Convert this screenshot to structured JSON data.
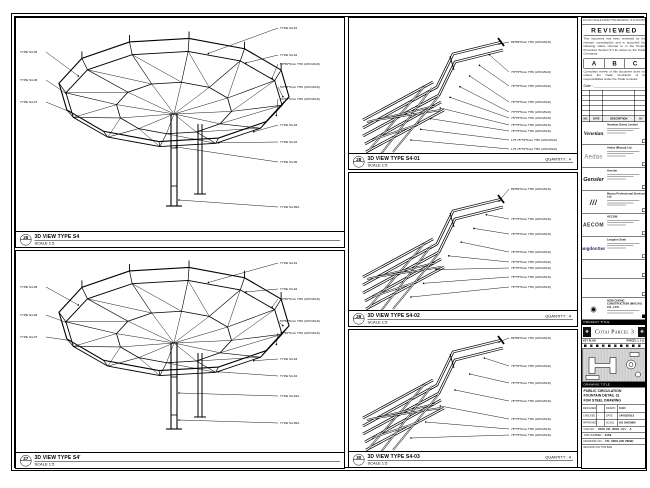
{
  "panels": {
    "left_top": {
      "ref": "26",
      "title": "3D VIEW TYPE S4",
      "scale": "SCALE 1:5",
      "left_labels": [
        "TYPE S4-05",
        "TYPE S4-06",
        "TYPE S4-07"
      ],
      "right_labels": [
        "TYPE S4-01",
        "TYPE S4-02",
        "50*50*5mm THK (A53 MILD)",
        "50*50*5mm THK (A53 MILD)",
        "50*50*5mm THK (A53 MILD)",
        "TYPE S4-03",
        "TYPE S4-04",
        "TYPE S4-05",
        "TYPE S4-05A"
      ]
    },
    "left_bottom": {
      "ref": "27",
      "title": "3D VIEW TYPE S4'",
      "scale": "SCALE 1:5",
      "left_labels": [
        "TYPE S4-05",
        "TYPE S4-06",
        "TYPE S4-07"
      ],
      "right_labels": [
        "TYPE S4-01",
        "TYPE S4-02",
        "50*50*5mm THK (A53 MILD)",
        "50*50*5mm THK (A53 MILD)",
        "50*50*5mm THK (A53 MILD)",
        "TYPE S4-03",
        "TYPE S4-04",
        "TYPE S4-04A",
        "TYPE S4-05A"
      ]
    },
    "mid_top": {
      "ref": "28",
      "title": "3D VIEW TYPE S4-01",
      "scale": "SCALE 1:5",
      "quantity": "QUANTITY : 4",
      "labels": [
        "89*89*5mm THK (A53 MILD)",
        "75*75*5mm THK (A53 MILD)",
        "75*75*5mm THK (A53 MILD)",
        "75*75*5mm THK (A53 MILD)",
        "75*75*5mm THK (A53 MILD)",
        "75*75*5mm THK (A53 MILD)",
        "75*75*5mm THK (A53 MILD)",
        "75*75*5mm THK (A53 MILD)",
        "L75 75*75*5mm THK (A53 MILD)",
        "L75 75*75*5mm THK (A53 MILD)"
      ]
    },
    "mid_mid": {
      "ref": "29",
      "title": "3D VIEW TYPE S4-02",
      "scale": "SCALE 1:5",
      "quantity": "QUANTITY : 4",
      "labels": [
        "89*89*5mm THK (A53 MILD)",
        "75*75*5mm THK (A53 MILD)",
        "75*75*5mm THK (A53 MILD)",
        "75*75*5mm THK (A53 MILD)",
        "75*75*5mm THK (A53 MILD)",
        "75*75*5mm THK (A53 MILD)",
        "75*75*5mm THK (A53 MILD)",
        "75*75*5mm THK (A53 MILD)"
      ]
    },
    "mid_bot": {
      "ref": "30",
      "title": "3D VIEW TYPE S4-03",
      "scale": "SCALE 1:5",
      "quantity": "QUANTITY : 4",
      "labels": [
        "89*89*5mm THK (A53 MILD)",
        "75*75*5mm THK (A53 MILD)",
        "75*75*5mm THK (A53 MILD)",
        "75*75*5mm THK (A53 MILD)",
        "75*75*5mm THK (A53 MILD)",
        "75*75*5mm THK (A53 MILD)",
        "75*75*5mm THK (A53 MILD)"
      ]
    }
  },
  "titleblock": {
    "top_note": "DO NOT SCALE FROM THIS DRAWING. IF IN DOUBT ASK.",
    "reviewed": {
      "title": "REVIEWED",
      "para1": "This document has been reviewed by the relevant consultant(s) and is accorded the following status referred to in the Project Procedure Section 5.4 for action by the Trade Contractor.",
      "grades": [
        "A",
        "B",
        "C"
      ],
      "para2": "Consultant review of this document does not relieve the Trade Contractor of its responsibilities under the Trade Contract.",
      "date_label": "Date :"
    },
    "revision_header": [
      "NO.",
      "DATE",
      "DESCRIPTION",
      "BY"
    ],
    "parties": [
      {
        "logo": "Venetian",
        "name": "Venetian Orient Limited"
      },
      {
        "logo": "Aedas",
        "name": "Aedas (Macau) Ltd."
      },
      {
        "logo": "Gensler",
        "name": "Gensler"
      },
      {
        "logo": "///",
        "name": "Macau Professional Services Ltd."
      },
      {
        "logo": "AECOM",
        "name": "AECOM"
      },
      {
        "logo": "LangdonSeah",
        "name": "Langdon Seah"
      }
    ],
    "contractor": {
      "emblem": "◉",
      "name": "HSIN CHONG CONSTRUCTION (MACAU) CO., LTD."
    },
    "project_title_label": "PROJECT TITLE",
    "project_title": "Cotai Parcel 3",
    "banner_ornament": "❖",
    "key_plan_label": "KEY PLAN",
    "key_plan_note": "PARCEL 1, 2 & 3",
    "drawing_title_label": "DRAWING TITLE",
    "drawing_title_lines": [
      "PUBLIC CIRCULATION",
      "FOUNTAIN DETAIL 31",
      "FOR STEEL DRAWING"
    ],
    "fields": {
      "r1": [
        "DESIGNED",
        "",
        "DRAWN",
        "CAD"
      ],
      "r2": [
        "CHECKED",
        "-",
        "DATE",
        "14/03/2013"
      ],
      "r3": [
        "APPROVED",
        "-",
        "SCALE",
        "AS SHOWN"
      ]
    },
    "cad_label": "CAD NO. :",
    "cad_no": "3159_FD_3D01",
    "rev_label": "REV :",
    "rev": "A",
    "job_label": "JOB NUMBER :",
    "job": "3159",
    "dwg_label": "DRAWING NO. :",
    "dwg": "FD_3D01 (3D VIEW)",
    "footer_note": "REVISION ON THIS BAR"
  }
}
